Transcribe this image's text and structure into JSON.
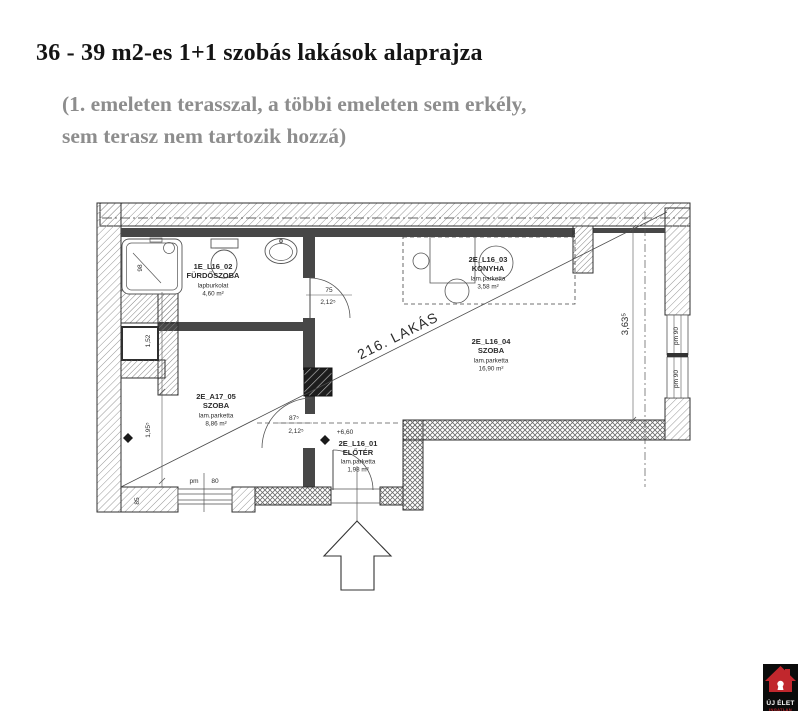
{
  "title": "36 - 39 m2-es 1+1 szobás lakások alaprajza",
  "subtitle_line1": "(1. emeleten terasszal, a többi emeleten sem erkély,",
  "subtitle_line2": "sem terasz nem tartozik hozzá)",
  "plan": {
    "apartment_ref": "216. LAKÁS",
    "entrance_level": "+6,60",
    "rooms": [
      {
        "id": "1E_L16_02",
        "name": "FÜRDŐSZOBA",
        "material": "lapburkolat",
        "area": "4,60 m²"
      },
      {
        "id": "2E_L16_03",
        "name": "KONYHA",
        "material": "lam.parketta",
        "area": "3,58 m²"
      },
      {
        "id": "2E_L16_04",
        "name": "SZOBA",
        "material": "lam.parketta",
        "area": "16,90 m²"
      },
      {
        "id": "2E_A17_05",
        "name": "SZOBA",
        "material": "lam.parketta",
        "area": "8,86 m²"
      },
      {
        "id": "2E_L16_01",
        "name": "ELŐTÉR",
        "material": "lam.parketta",
        "area": "1,98 m²"
      }
    ],
    "dims": {
      "shower_width": "98",
      "shaft_height": "1,52",
      "bath_door_width": "75",
      "bath_door_height": "2,12⁵",
      "room_door_width": "87⁵",
      "room_door_height": "2,12⁵",
      "room_width": "1,95⁵",
      "wall_width": "85",
      "window_bottom_label": "pm",
      "window_bottom_size": "80",
      "window_right_upper": "pm 90",
      "window_right_lower": "pm 90",
      "room_depth": "3,63⁵"
    }
  },
  "logo": {
    "name": "ÚJ ÉLET",
    "tagline": "INGATLAN"
  }
}
